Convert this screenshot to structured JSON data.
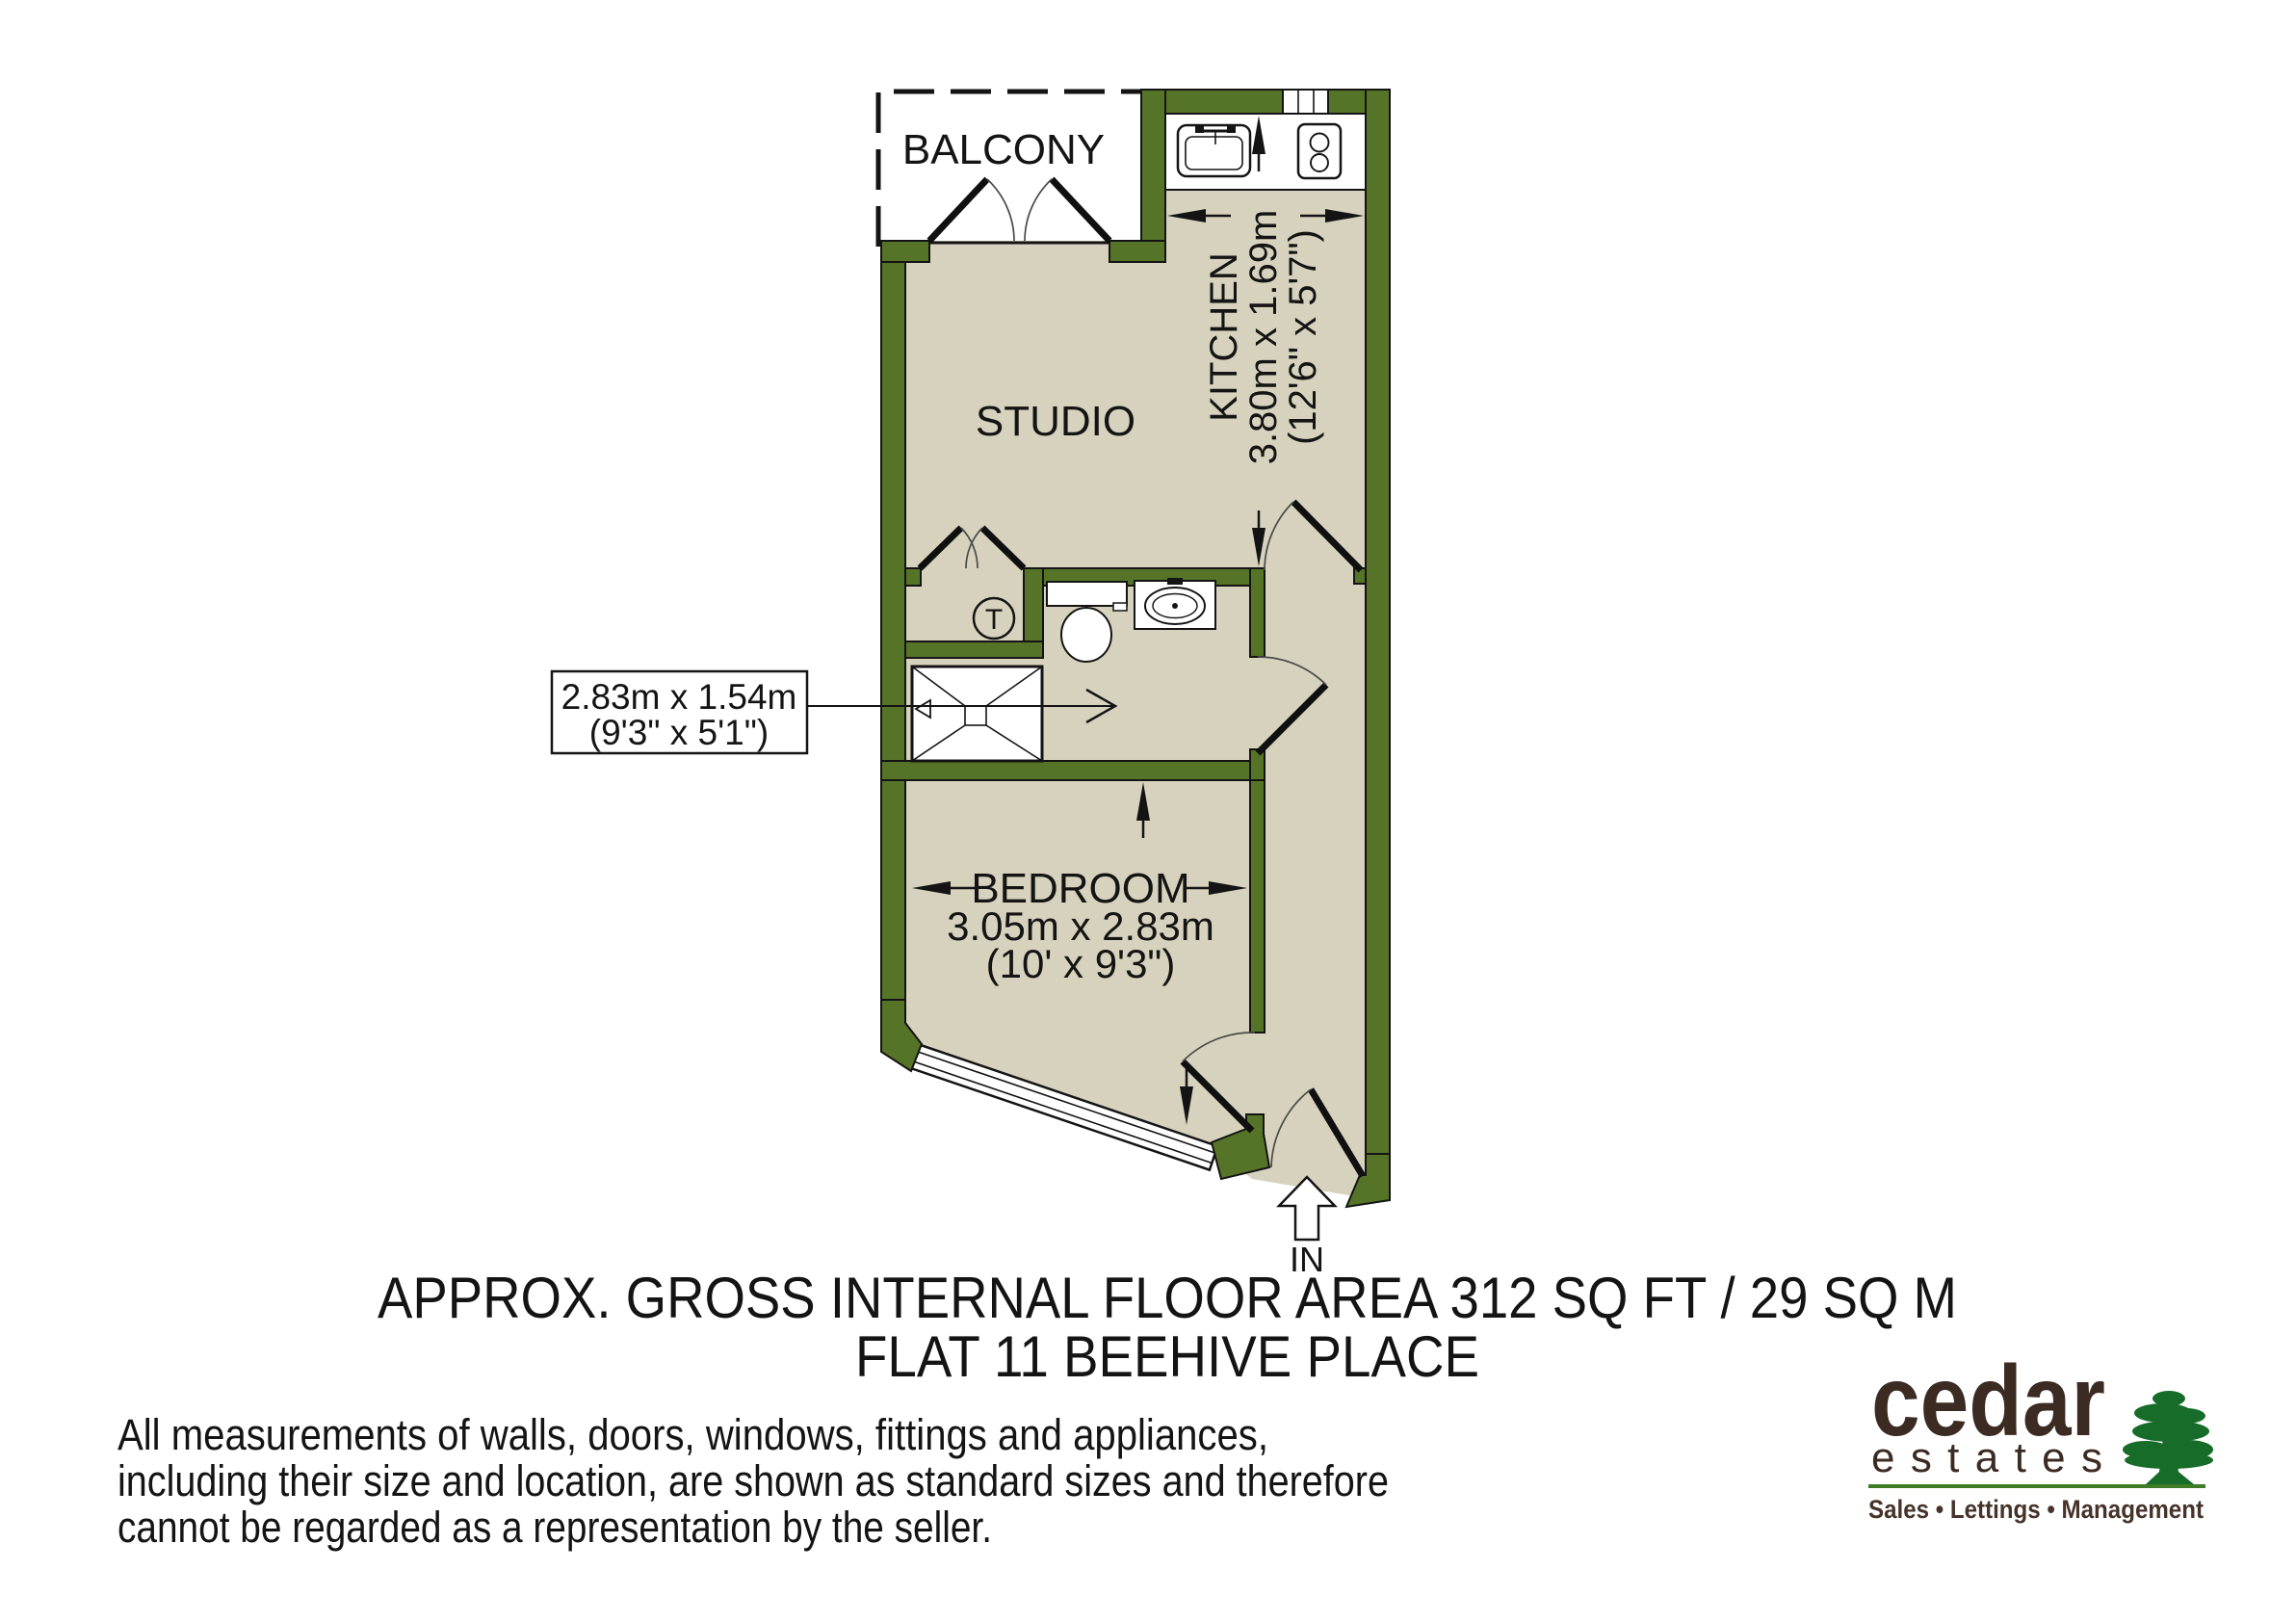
{
  "colors": {
    "wall": "#567428",
    "floor": "#d6d2bd",
    "line": "#141414",
    "logo_green": "#186c2a",
    "logo_rule_green": "#3e7c26",
    "logo_brown": "#3b2b22"
  },
  "plan": {
    "balcony": {
      "label": "BALCONY"
    },
    "studio": {
      "label": "STUDIO"
    },
    "kitchen": {
      "label": "KITCHEN",
      "size_metric": "3.80m x 1.69m",
      "size_imperial": "(12'6\" x 5'7\")"
    },
    "bathroom": {
      "size_metric": "2.83m x 1.54m",
      "size_imperial": "(9'3\" x 5'1\")",
      "tank_label": "T"
    },
    "bedroom": {
      "label": "BEDROOM",
      "size_metric": "3.05m x 2.83m",
      "size_imperial": "(10' x 9'3\")"
    },
    "entrance": {
      "label": "IN"
    }
  },
  "title": {
    "line1": "APPROX. GROSS INTERNAL FLOOR AREA 312 SQ FT / 29 SQ M",
    "line2": "FLAT 11 BEEHIVE PLACE"
  },
  "disclaimer": {
    "lines": [
      "All measurements of walls, doors, windows, fittings and appliances,",
      "including their size and location, are shown as standard sizes and therefore",
      "cannot be regarded as a representation by the seller."
    ]
  },
  "logo": {
    "brand": "cedar",
    "brand2": "estates",
    "tagline": "Sales • Lettings • Management"
  }
}
